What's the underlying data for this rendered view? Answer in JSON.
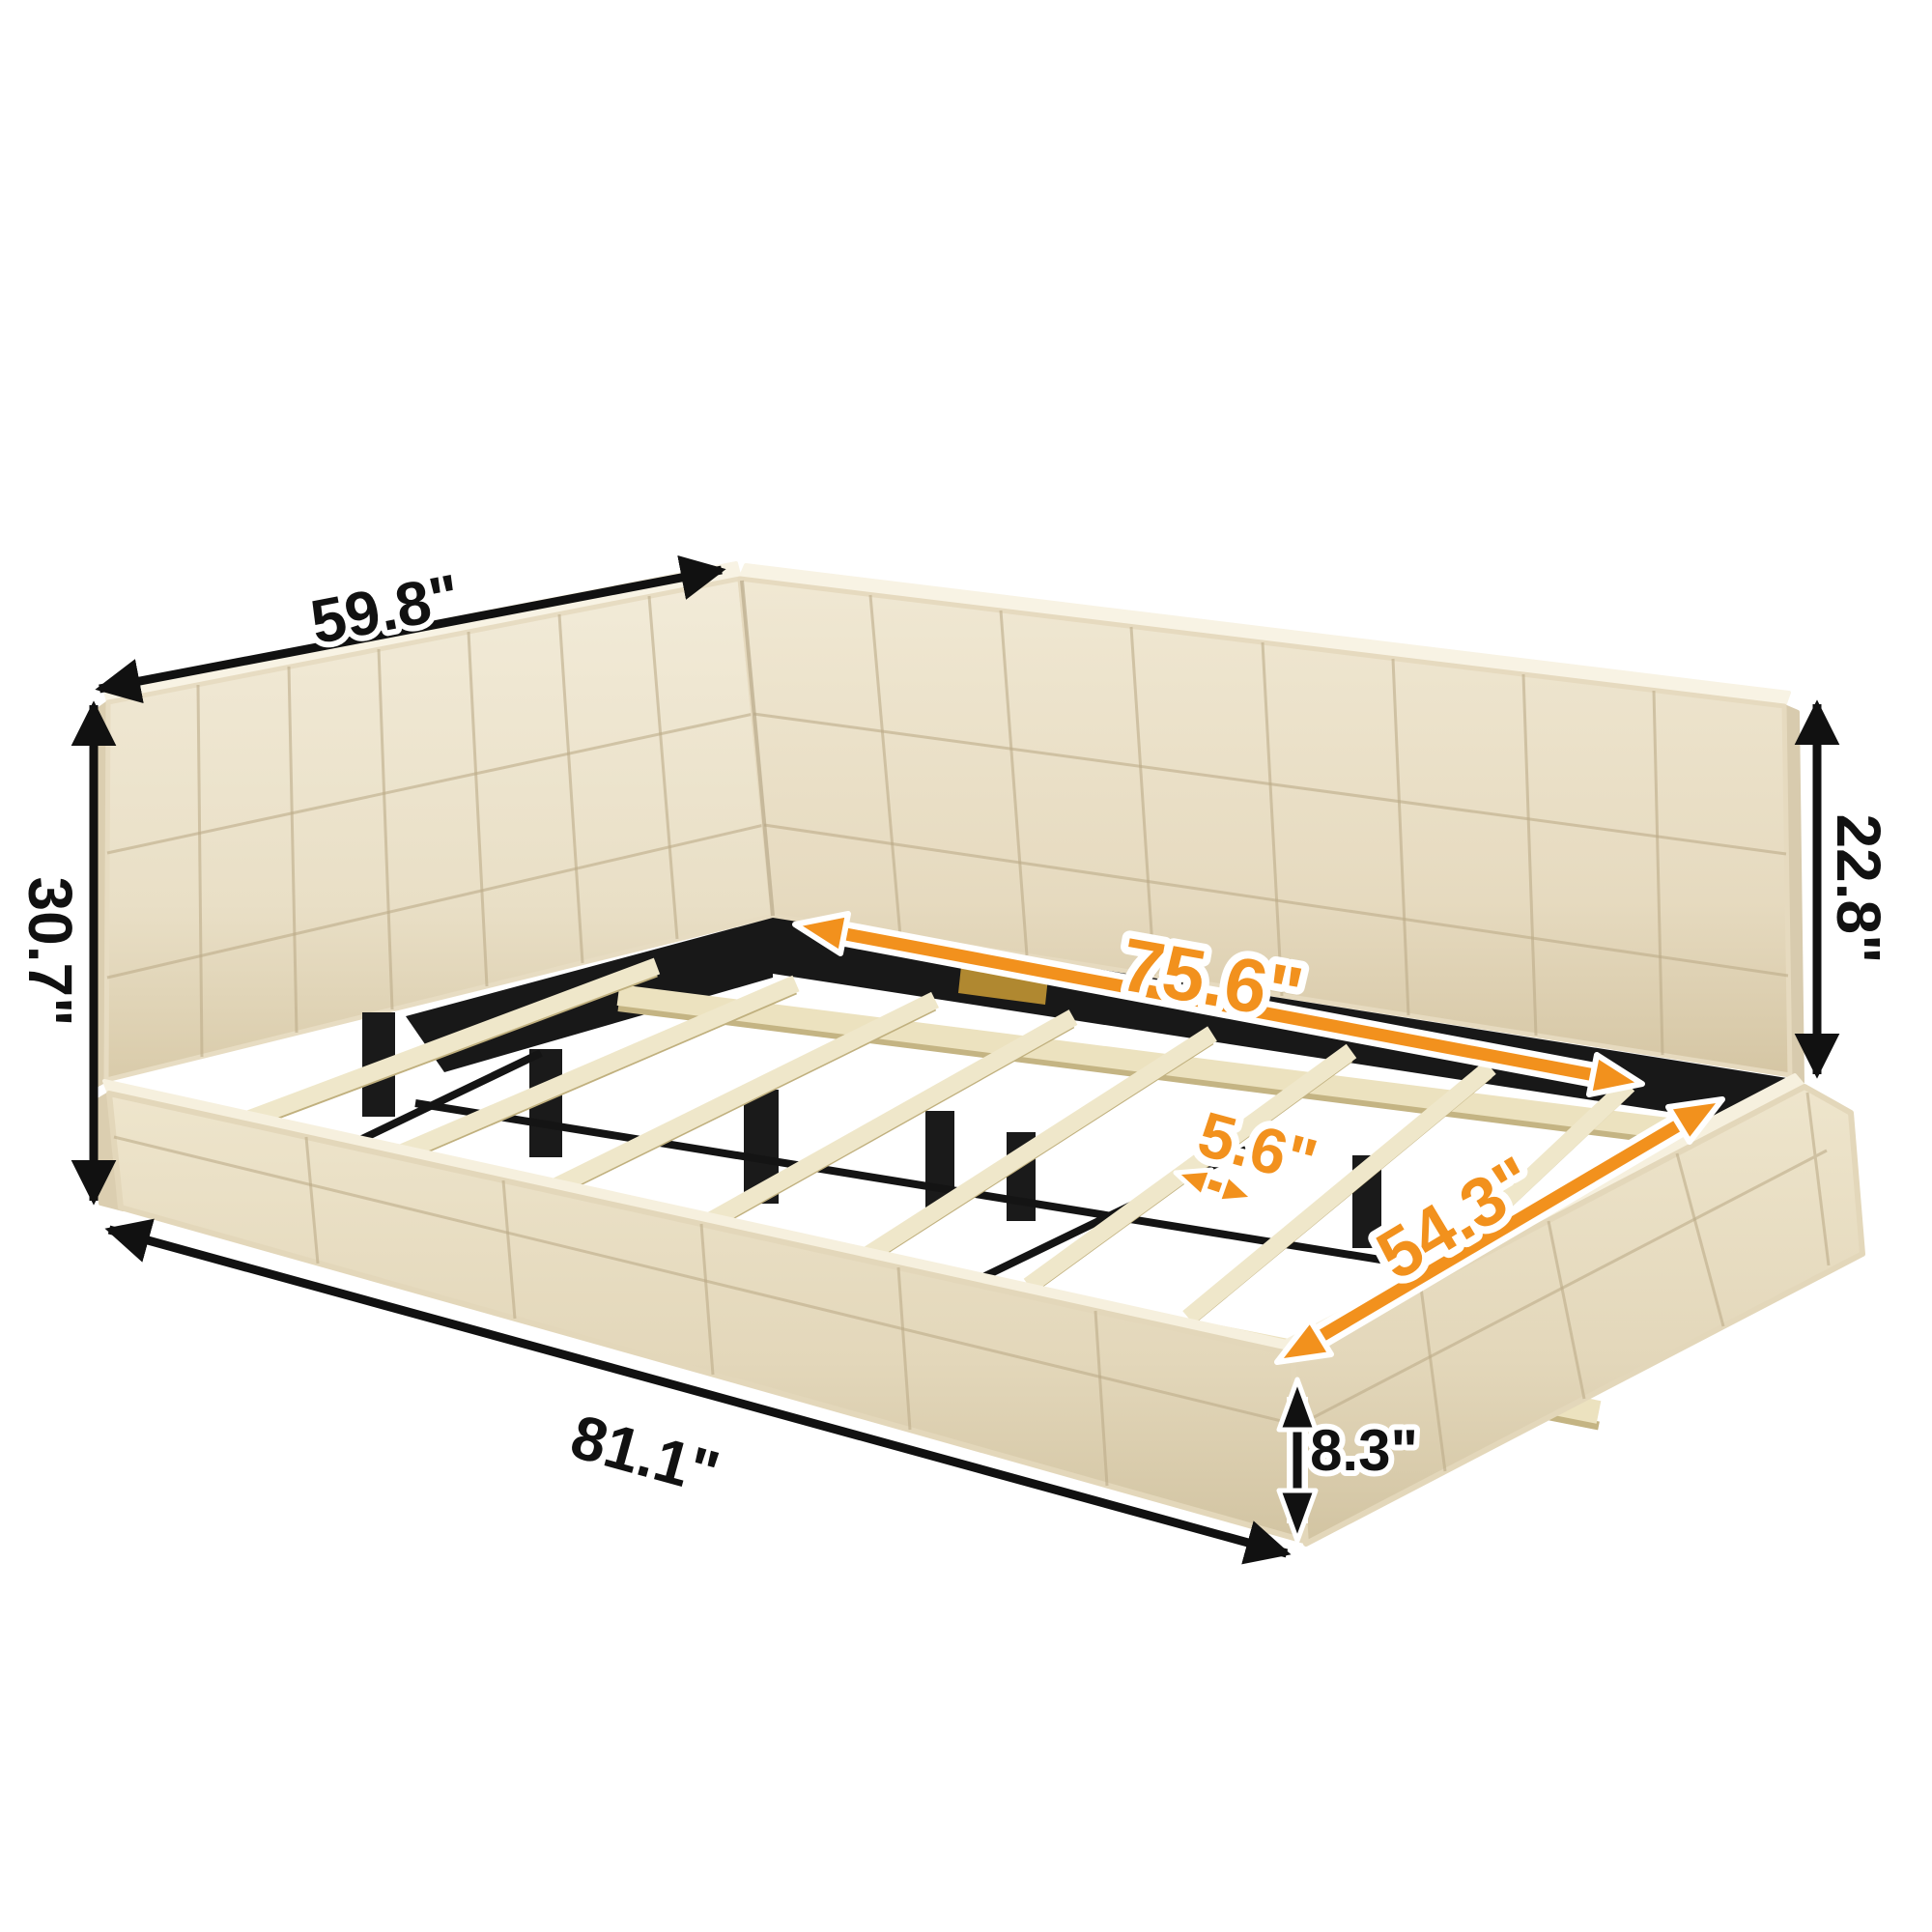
{
  "title": "SIZE: INCH",
  "subject": "upholstered daybed platform bed with L-shaped backrest and wooden slats",
  "unit": "INCH",
  "dimensions": {
    "headboard_width": "59.8\"",
    "headboard_height": "30.7\"",
    "back_wall_height": "22.8\"",
    "inner_length": "75.6\"",
    "slat_spacing": "5.6\"",
    "inner_width": "54.3\"",
    "overall_length": "81.1\"",
    "base_height": "8.3\""
  },
  "colors": {
    "dimension_primary": "#111111",
    "dimension_accent": "#f2911d",
    "fabric_light": "#f2ebd8",
    "fabric_shadow": "#d9cbaa",
    "slat_wood": "#efe7ca",
    "metal_frame": "#1a1a1a",
    "background": "#ffffff"
  }
}
